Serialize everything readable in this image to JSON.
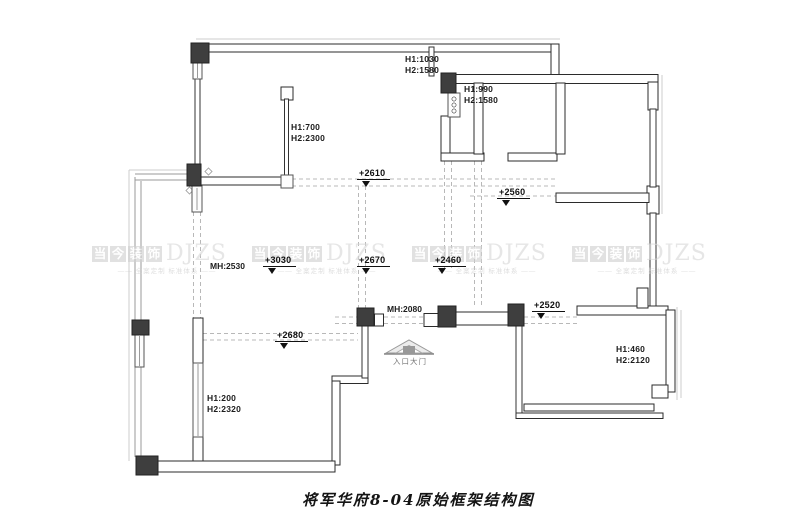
{
  "title": "将军华府8-04原始框架结构图",
  "watermark": {
    "brand_chars": [
      "当",
      "今",
      "装",
      "饰"
    ],
    "brand_en": "DJZS",
    "tagline": "—— 全案定制 标准体系 ——"
  },
  "entrance": {
    "label": "入口大门"
  },
  "levels": [
    {
      "text": "+2610"
    },
    {
      "text": "+2560"
    },
    {
      "text": "+3030"
    },
    {
      "text": "+2670"
    },
    {
      "text": "+2460"
    },
    {
      "text": "+2680"
    },
    {
      "text": "+2520"
    }
  ],
  "door_heights": [
    {
      "text": "MH:2530"
    },
    {
      "text": "MH:2080"
    }
  ],
  "window_heights": [
    {
      "line1": "H1:1030",
      "line2": "H2:1580"
    },
    {
      "line1": "H1:990",
      "line2": "H2:1580"
    },
    {
      "line1": "H1:700",
      "line2": "H2:2300"
    },
    {
      "line1": "H1:200",
      "line2": "H2:2320"
    },
    {
      "line1": "H1:460",
      "line2": "H2:2120"
    }
  ],
  "colors": {
    "wall_stroke": "#2b2b2b",
    "wall_fill": "#ffffff",
    "column_fill": "#3e3e3e",
    "dash_line": "#b8b8b8",
    "shadow_line": "#cccccc",
    "watermark_gray": "#cfcfcf"
  }
}
